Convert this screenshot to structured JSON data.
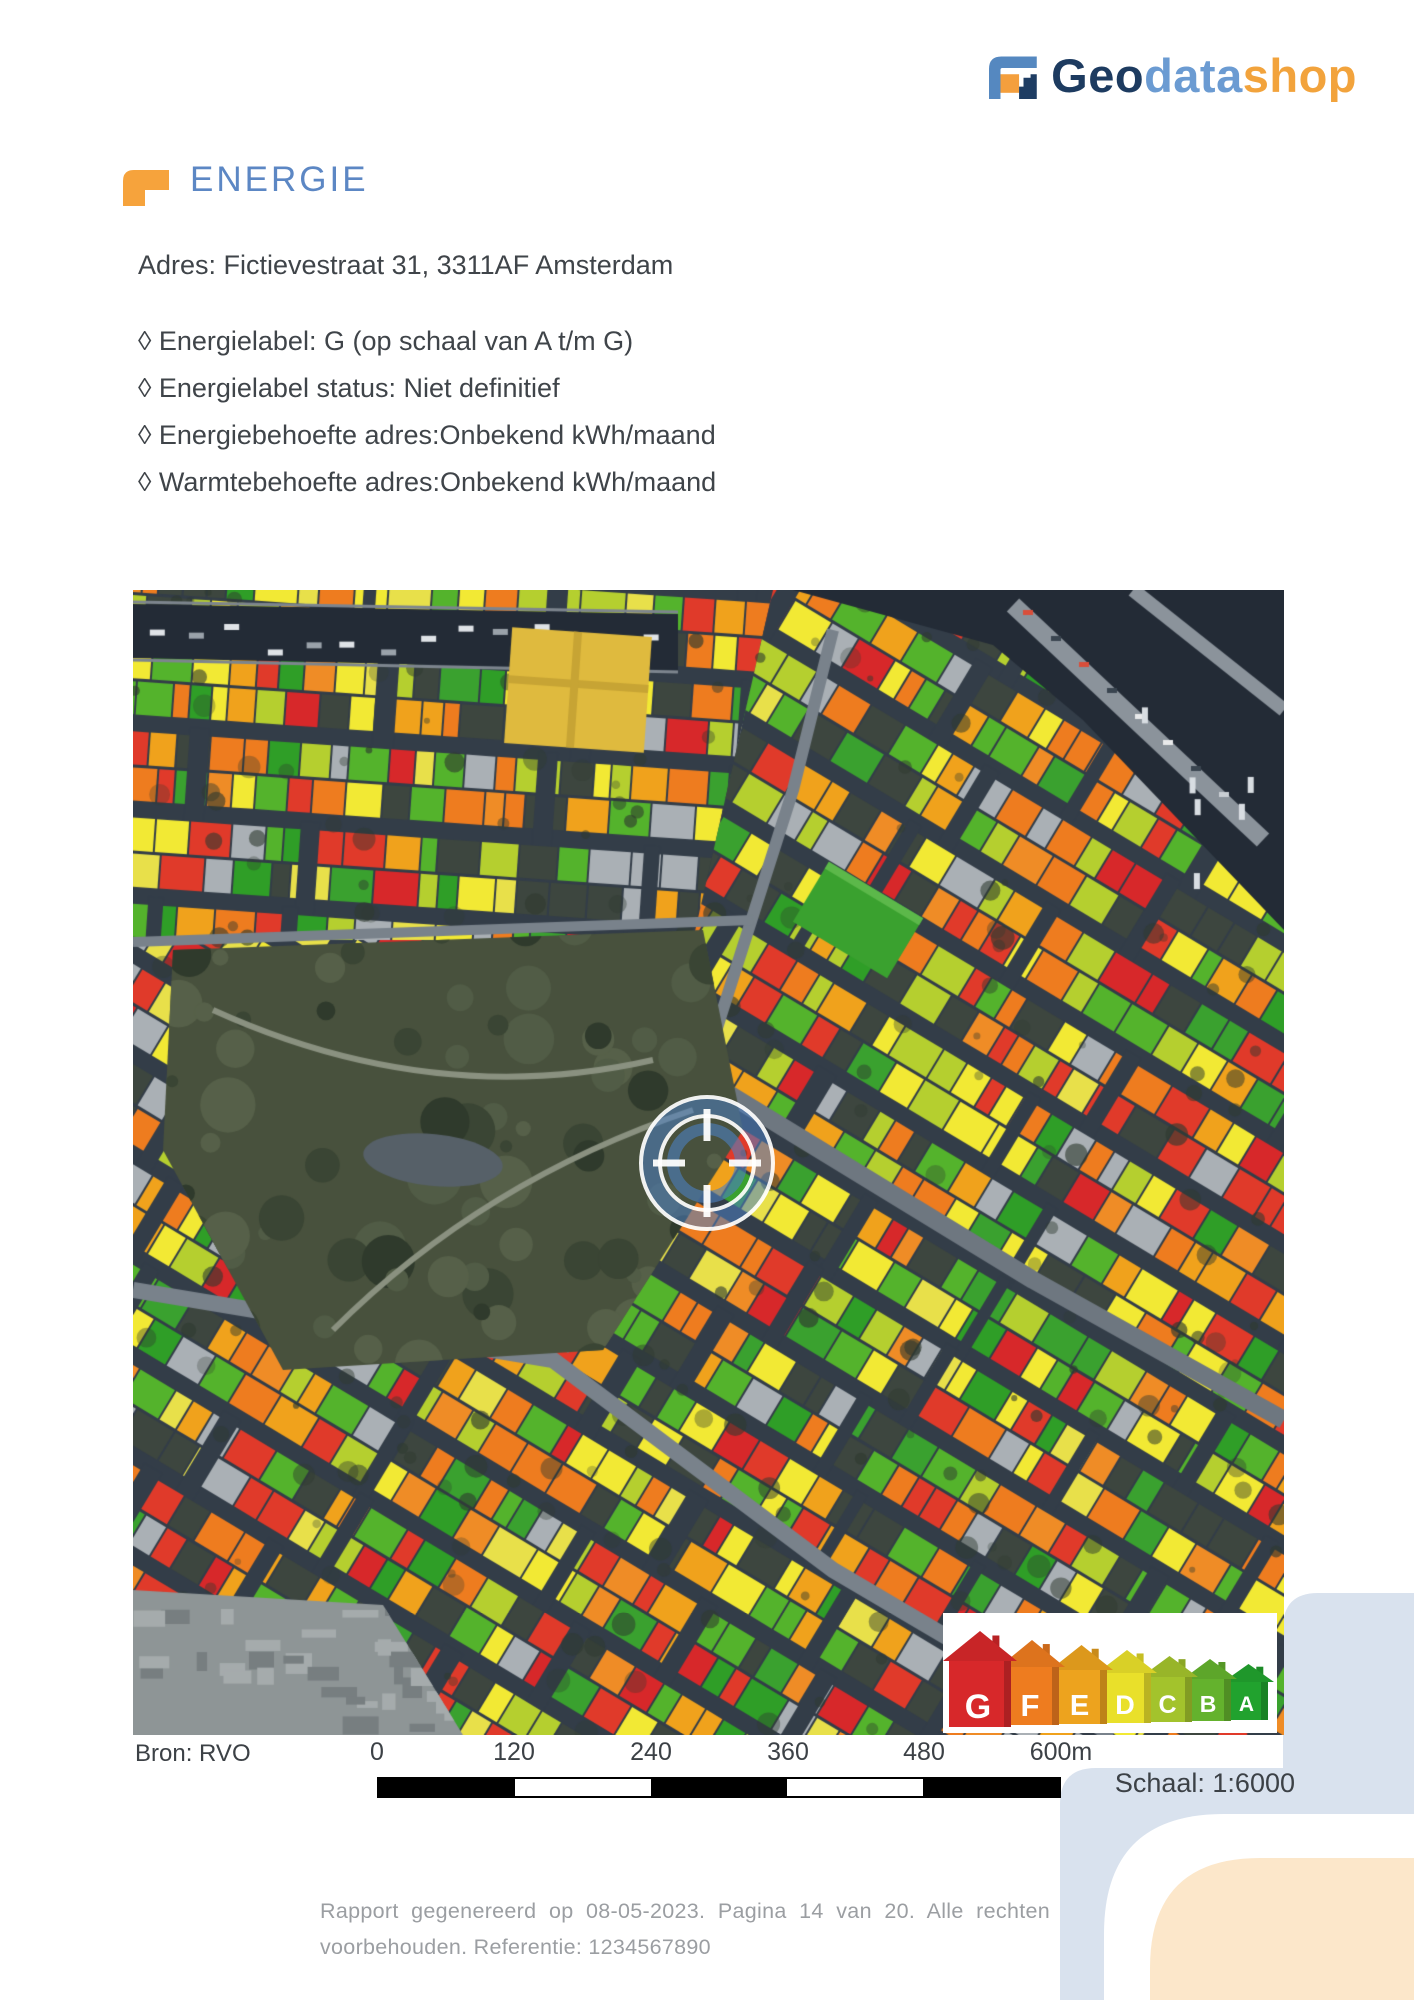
{
  "logo": {
    "geo": "Geo",
    "data": "data",
    "shop": "shop"
  },
  "page_header": {
    "title": "ENERGIE"
  },
  "address_line": "Adres: Fictievestraat 31, 3311AF Amsterdam",
  "bullets": [
    {
      "text": "◊ Energielabel: G (op schaal van A t/m G)"
    },
    {
      "text": "◊ Energielabel status: Niet definitief"
    },
    {
      "text": "◊ Energiebehoefte adres:Onbekend kWh/maand"
    },
    {
      "text": "◊ Warmtebehoefte adres:Onbekend kWh/maand"
    }
  ],
  "map": {
    "source_label": "Bron: RVO",
    "scale_ticks": [
      "0",
      "120",
      "240",
      "360",
      "480",
      "600m"
    ],
    "scale_label": "Schaal: 1:6000",
    "legend": [
      {
        "label": "G",
        "color": "#d7282a"
      },
      {
        "label": "F",
        "color": "#ee7c1f"
      },
      {
        "label": "E",
        "color": "#eda31e"
      },
      {
        "label": "D",
        "color": "#e9e02a"
      },
      {
        "label": "C",
        "color": "#a3c32c"
      },
      {
        "label": "B",
        "color": "#64b22d"
      },
      {
        "label": "A",
        "color": "#21a22e"
      }
    ],
    "palette_buildings": [
      "#e03a2a",
      "#e03a2a",
      "#d7282a",
      "#ee7c1f",
      "#ee7c1f",
      "#ef8c26",
      "#f0a21c",
      "#f0a21c",
      "#f2e934",
      "#f2e934",
      "#e8e04a",
      "#b5cf2f",
      "#b5cf2f",
      "#54b32c",
      "#54b32c",
      "#3aa12f",
      "#2f9e27"
    ],
    "ground": {
      "street": "#333d48",
      "water": "#232b36",
      "road": "#79828b",
      "park": "#48513d",
      "construction": "#8e9596",
      "quay": "#7d858e"
    },
    "marker_color": "#4d80c2"
  },
  "footer": {
    "line1": "Rapport gegenereerd op 08-05-2023. Pagina 14 van 20. Alle rechten",
    "line2": "voorbehouden. Referentie: 1234567890"
  },
  "brand_colors": {
    "navy": "#1d3b60",
    "blue": "#6b9bd2",
    "orange": "#f2a33c",
    "heading_blue": "#5c87c4",
    "deco_blue": "#d9e2ee",
    "deco_peach": "#fce7ca"
  }
}
